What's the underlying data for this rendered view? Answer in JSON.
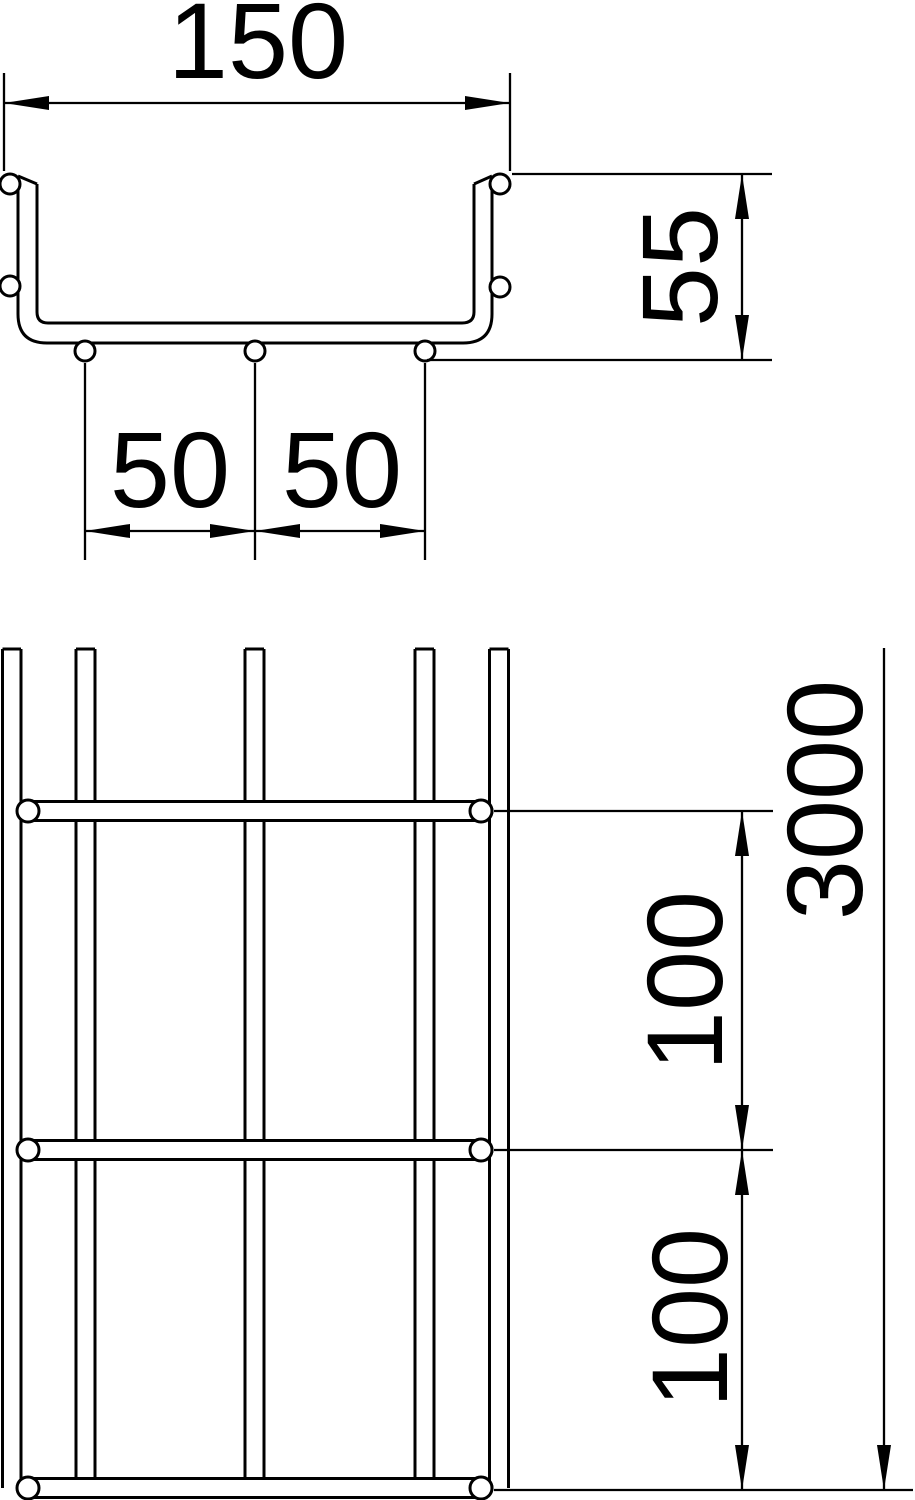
{
  "figure": {
    "kind": "technical-dimension-drawing",
    "colors": {
      "line": "#000000",
      "background": "#ffffff"
    }
  },
  "cross_section": {
    "width_label": "150",
    "height_label": "55",
    "spacing_left_label": "50",
    "spacing_right_label": "50"
  },
  "plan_view": {
    "length_label": "3000",
    "pitch_upper_label": "100",
    "pitch_lower_label": "100"
  }
}
